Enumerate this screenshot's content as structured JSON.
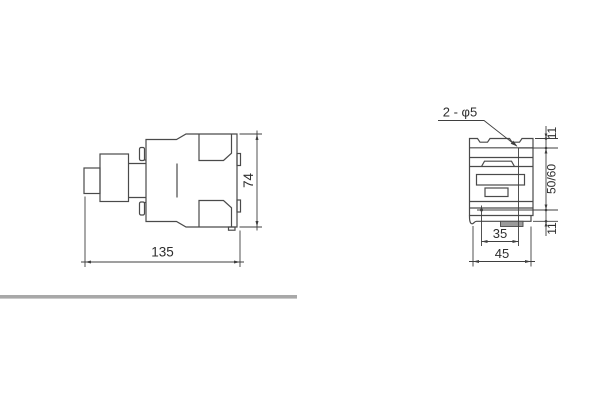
{
  "drawing": {
    "title_hint": "contactor outline and mounting dimension drawing",
    "side_view": {
      "width_dim": "135",
      "height_dim": "74"
    },
    "front_view": {
      "hole_callout": "2 - φ5",
      "top_offset_dim": "11",
      "hole_spacing_dim": "50/60",
      "bottom_offset_dim": "11",
      "hole_span_dim": "35",
      "width_dim": "45"
    },
    "colors": {
      "line": "#4a4a4a",
      "dimension_line": "#3f3f3f",
      "text": "#2e2e2e",
      "rail_clip_fill": "#9b9b9b",
      "separator_bar": "#a8a8a8",
      "background": "#ffffff"
    }
  }
}
